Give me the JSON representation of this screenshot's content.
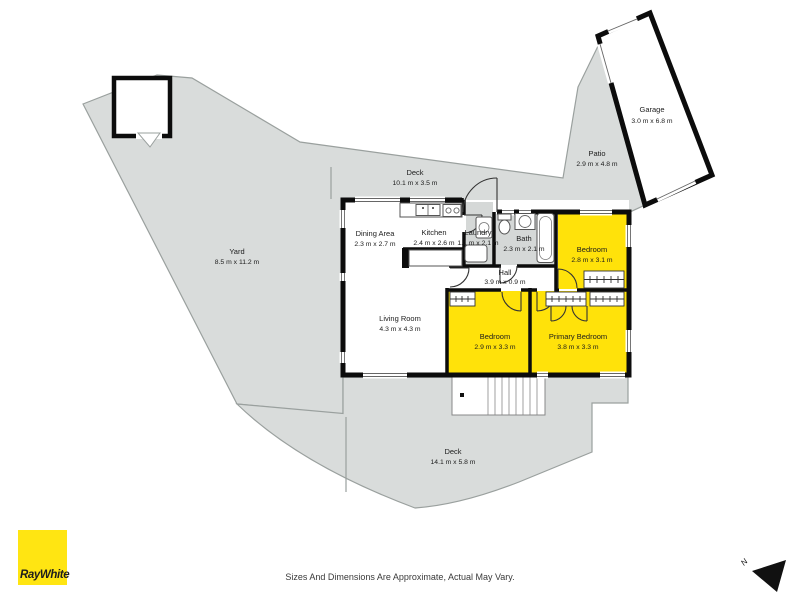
{
  "branding": {
    "agency": "RayWhite",
    "logo_color": "#FFE512",
    "logo_text_color": "#1d1d1d"
  },
  "disclaimer": "Sizes And Dimensions Are Approximate, Actual May Vary.",
  "compass": {
    "label": "N"
  },
  "palette": {
    "outdoor": "#d9dcdb",
    "wet_room": "#d5d8d7",
    "highlight": "#ffe20a",
    "wall": "#0c0c0c",
    "outline": "#9aa09e",
    "label": "#1c1c1c"
  },
  "icons": [
    "north-arrow-icon",
    "toilet-icon",
    "bathroom-sink-icon",
    "bathtub-icon",
    "washing-machine-icon",
    "laundry-tub-icon",
    "kitchen-sink-icon",
    "stove-icon",
    "wardrobe-icon",
    "stairs-icon",
    "door-swing-icon"
  ],
  "rooms": [
    {
      "id": "garage",
      "name": "Garage",
      "dims": "3.0 m x 6.8 m"
    },
    {
      "id": "patio",
      "name": "Patio",
      "dims": "2.9 m x 4.8 m"
    },
    {
      "id": "deck-upper",
      "name": "Deck",
      "dims": "10.1 m x 3.5 m"
    },
    {
      "id": "yard",
      "name": "Yard",
      "dims": "8.5 m x 11.2 m"
    },
    {
      "id": "dining",
      "name": "Dining Area",
      "dims": "2.3 m x 2.7 m"
    },
    {
      "id": "kitchen",
      "name": "Kitchen",
      "dims": "2.4 m x 2.6 m"
    },
    {
      "id": "laundry",
      "name": "Laundry",
      "dims": "1.1 m x 2.1 m"
    },
    {
      "id": "bath",
      "name": "Bath",
      "dims": "2.3 m x 2.1 m"
    },
    {
      "id": "bedroom-1",
      "name": "Bedroom",
      "dims": "2.8 m x 3.1 m"
    },
    {
      "id": "hall",
      "name": "Hall",
      "dims": "3.9 m x 0.9 m"
    },
    {
      "id": "living",
      "name": "Living Room",
      "dims": "4.3 m x 4.3 m"
    },
    {
      "id": "bedroom-2",
      "name": "Bedroom",
      "dims": "2.9 m x 3.3 m"
    },
    {
      "id": "primary-bedroom",
      "name": "Primary Bedroom",
      "dims": "3.8 m x 3.3 m"
    },
    {
      "id": "deck-lower",
      "name": "Deck",
      "dims": "14.1 m x 5.8 m"
    }
  ]
}
